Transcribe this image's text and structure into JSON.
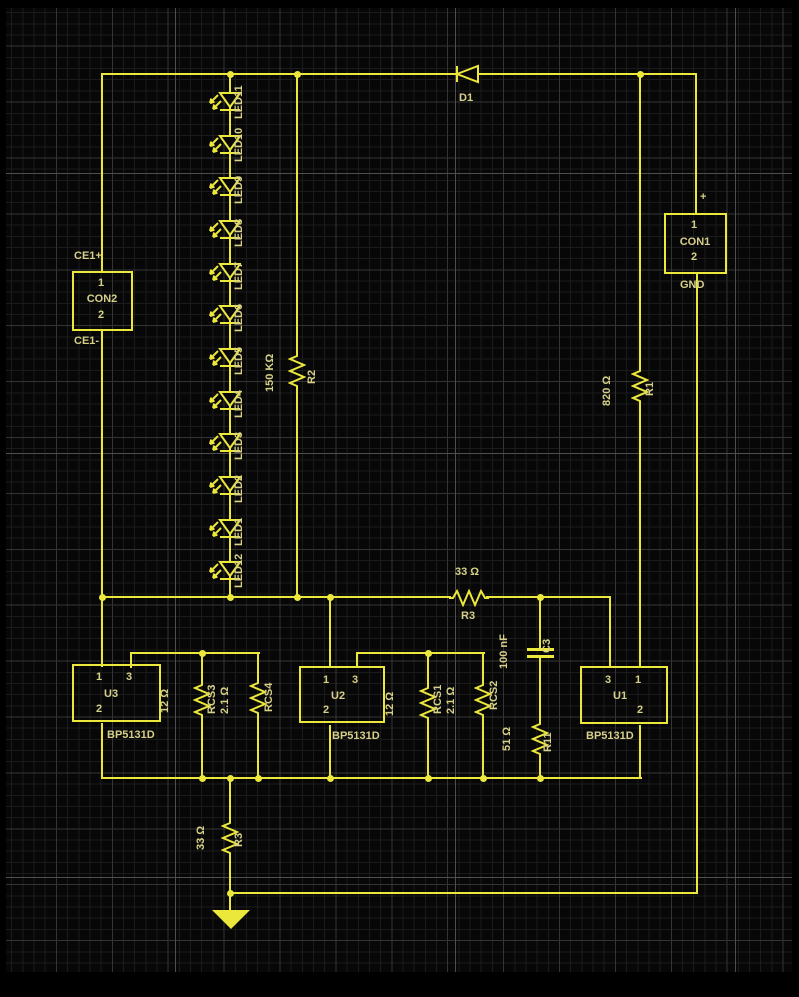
{
  "colors": {
    "wire": "#ece73b",
    "text": "#d6d088",
    "background": "#070707"
  },
  "schematic": {
    "leds": [
      "LED11",
      "LED10",
      "LED9",
      "LED8",
      "LED7",
      "LED6",
      "LED5",
      "LED4",
      "LED3",
      "LED2",
      "LED1",
      "LED12"
    ],
    "diode": {
      "refdes": "D1"
    },
    "connectors": {
      "con1": {
        "name": "CON1",
        "pin1": "1",
        "pin2": "2",
        "positive": "+",
        "ground": "GND"
      },
      "con2": {
        "name": "CON2",
        "pin1": "1",
        "pin2": "2",
        "top": "CE1+",
        "bottom": "CE1-"
      }
    },
    "resistors": {
      "r2": {
        "value": "150 KΩ",
        "refdes": "R2"
      },
      "r1": {
        "value": "820 Ω",
        "refdes": "R1"
      },
      "r3_mid": {
        "value": "33 Ω",
        "refdes": "R3"
      },
      "rcs3": {
        "value": "12 Ω",
        "refdes": "RCS3"
      },
      "rcs4": {
        "value": "2.1 Ω",
        "refdes": "RCS4"
      },
      "rcs1": {
        "value": "12 Ω",
        "refdes": "RCS1"
      },
      "rcs2": {
        "value": "2.1 Ω",
        "refdes": "RCS2"
      },
      "r11": {
        "value": "51 Ω",
        "refdes": "R11"
      },
      "r3_bottom": {
        "value": "33 Ω",
        "refdes": "R3"
      }
    },
    "capacitors": {
      "c3": {
        "value": "100 nF",
        "refdes": "C3"
      }
    },
    "ics": {
      "u3": {
        "refdes": "U3",
        "part": "BP5131D",
        "pin1": "1",
        "pin2": "2",
        "pin3": "3"
      },
      "u2": {
        "refdes": "U2",
        "part": "BP5131D",
        "pin1": "1",
        "pin2": "2",
        "pin3": "3"
      },
      "u1": {
        "refdes": "U1",
        "part": "BP5131D",
        "pin1": "1",
        "pin2": "2",
        "pin3": "3"
      }
    }
  }
}
